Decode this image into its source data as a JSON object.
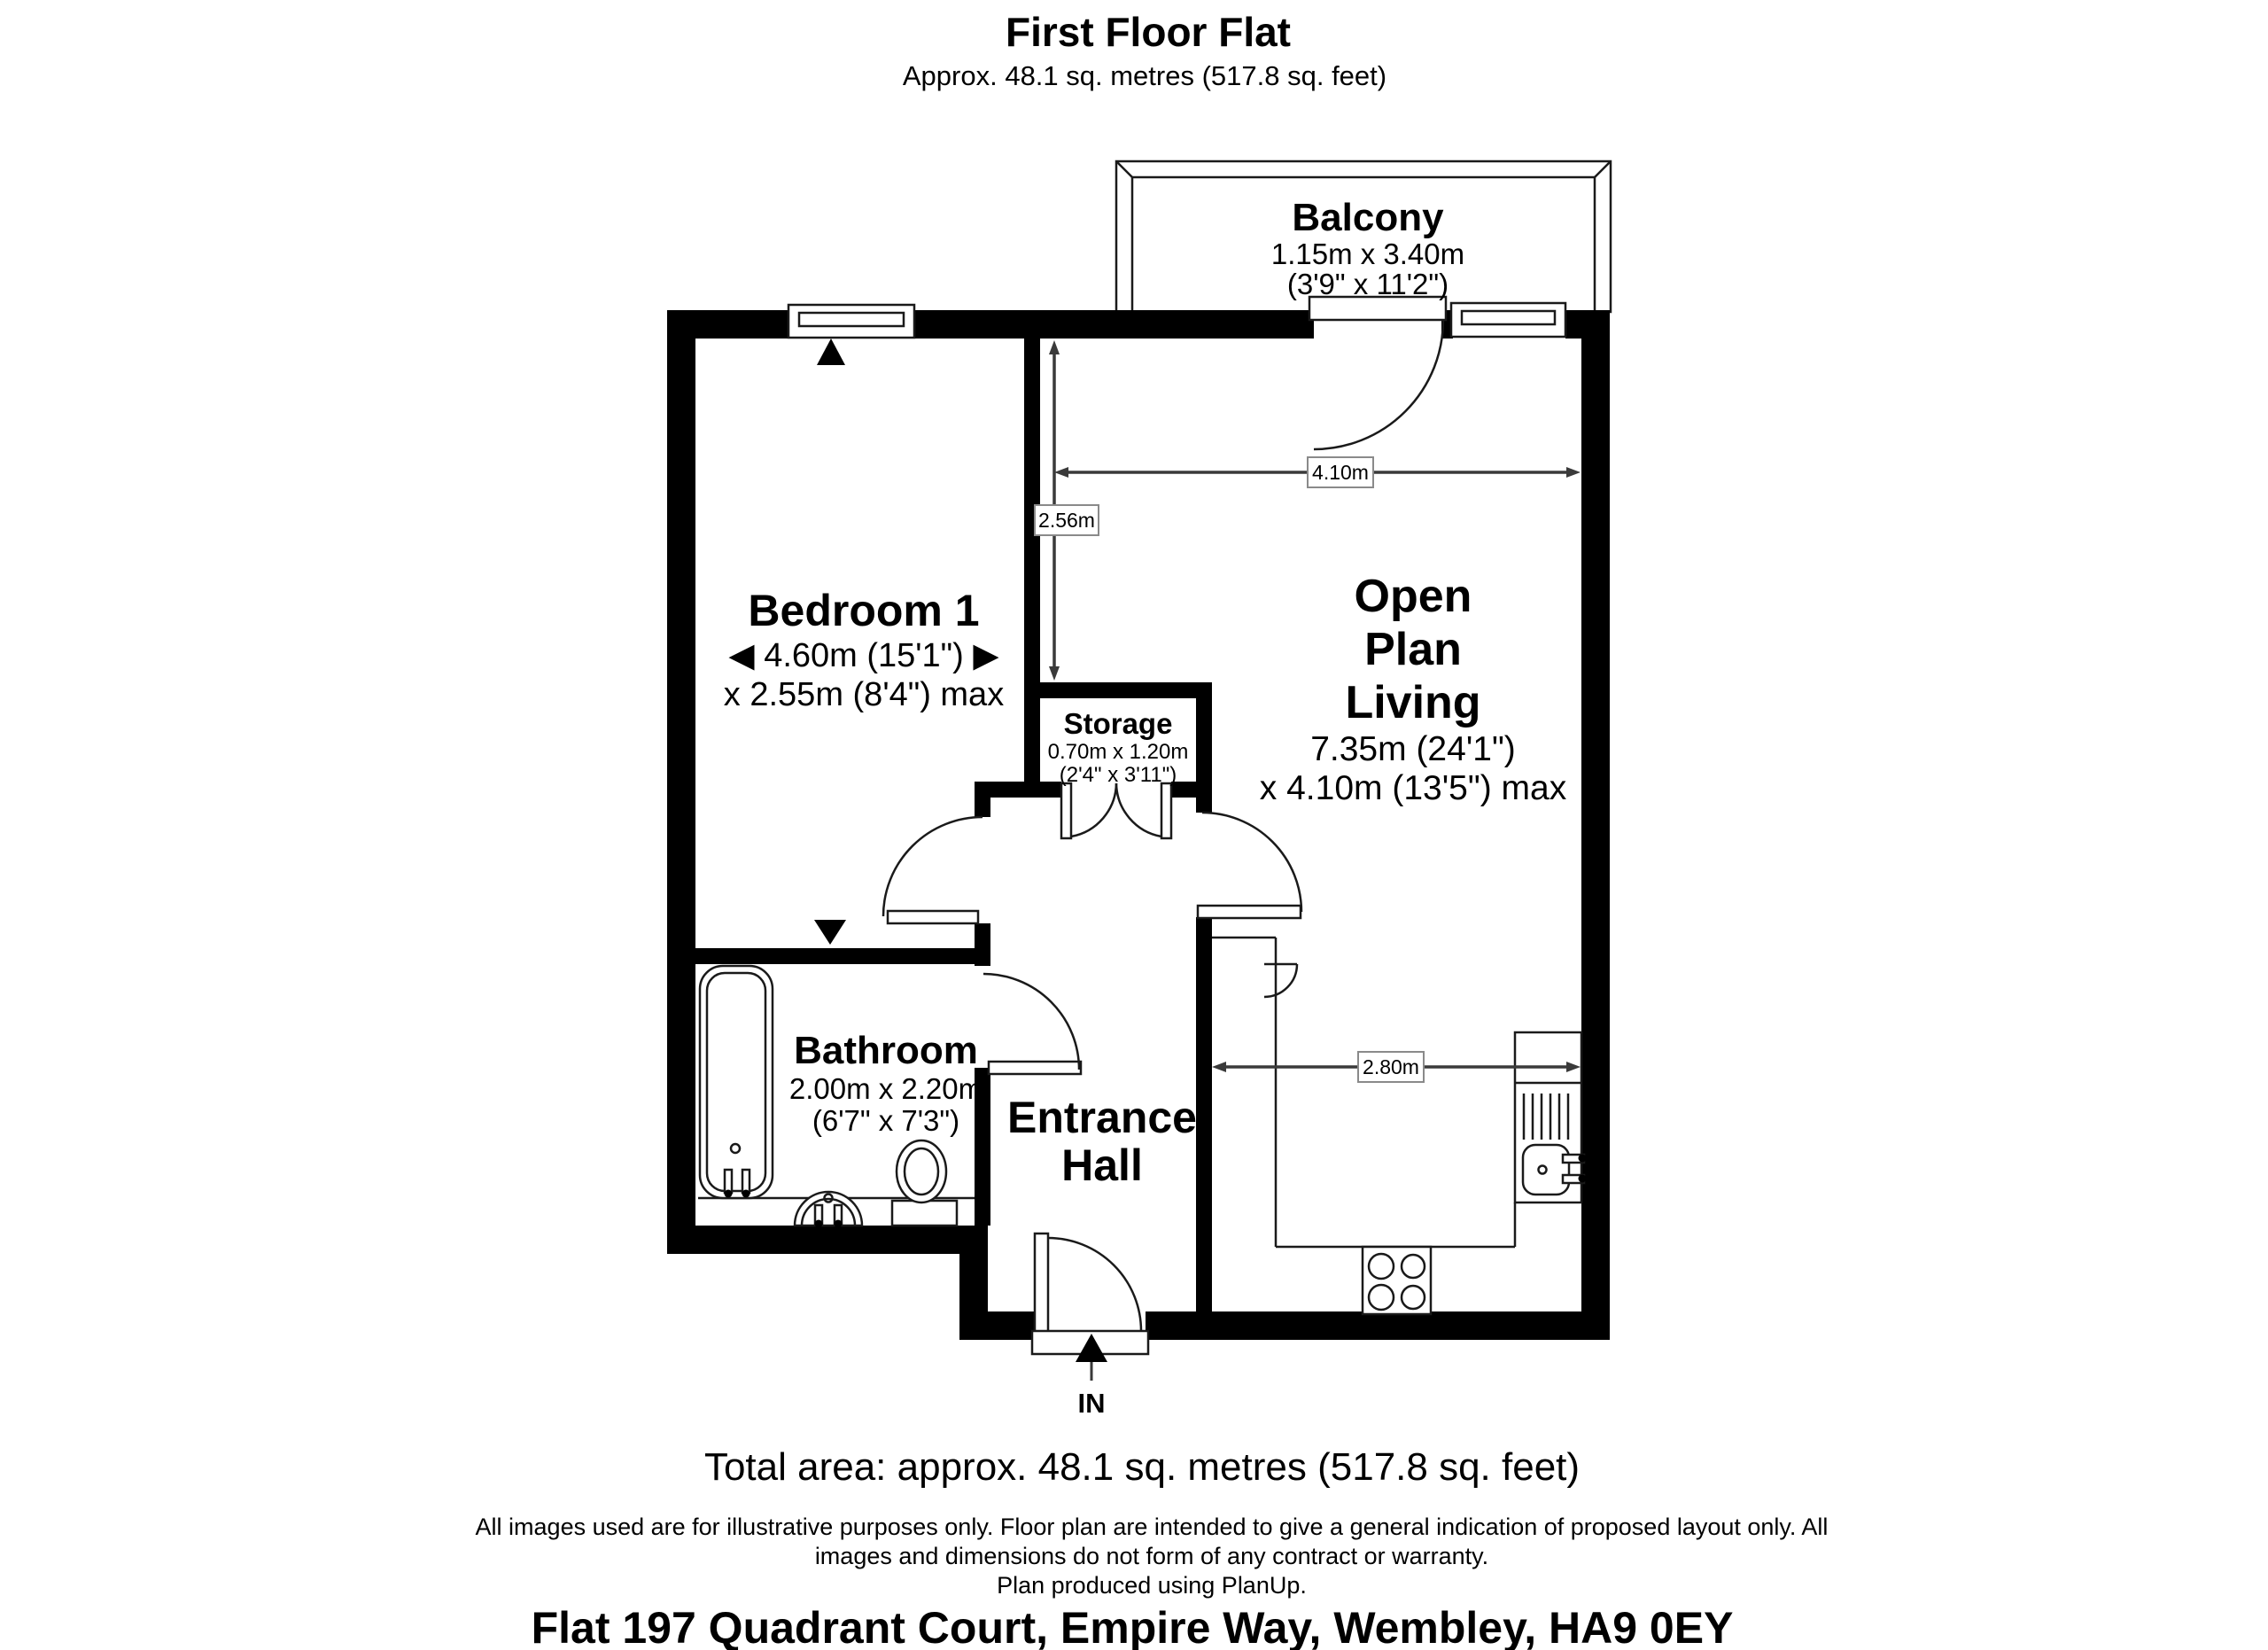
{
  "title": {
    "text": "First Floor Flat",
    "subtitle": "Approx. 48.1 sq. metres (517.8 sq. feet)"
  },
  "rooms": {
    "balcony": {
      "name": "Balcony",
      "dim_metric": "1.15m x 3.40m",
      "dim_imperial": "(3'9\" x 11'2\")"
    },
    "bedroom1": {
      "name": "Bedroom 1",
      "dim_line1": "◀ 4.60m (15'1\") ▶",
      "dim_line2": "x 2.55m (8'4\") max"
    },
    "open_plan_living": {
      "name_line1": "Open",
      "name_line2": "Plan",
      "name_line3": "Living",
      "dim_line1": "7.35m (24'1\")",
      "dim_line2": "x 4.10m (13'5\") max"
    },
    "storage": {
      "name": "Storage",
      "dim_metric": "0.70m x 1.20m",
      "dim_imperial": "(2'4\" x 3'11\")"
    },
    "bathroom": {
      "name": "Bathroom",
      "dim_metric": "2.00m x 2.20m",
      "dim_imperial": "(6'7\" x 7'3\")"
    },
    "entrance_hall": {
      "name_line1": "Entrance",
      "name_line2": "Hall"
    }
  },
  "dimensions": {
    "living_width": "4.10m",
    "living_depth": "2.56m",
    "kitchen_width": "2.80m"
  },
  "entrance_label": "IN",
  "footer": {
    "total_area": "Total area: approx. 48.1 sq. metres (517.8 sq. feet)",
    "disclaimer_line1": "All images used are for illustrative purposes only. Floor plan are intended to give a general indication of proposed layout only. All",
    "disclaimer_line2": "images and dimensions do not form of any contract or warranty.",
    "disclaimer_line3": "Plan produced using PlanUp.",
    "address": "Flat 197 Quadrant Court, Empire Way, Wembley, HA9 0EY"
  },
  "colors": {
    "wall": "#000000",
    "dimension_line": "#3a3a3a",
    "background": "#ffffff"
  }
}
